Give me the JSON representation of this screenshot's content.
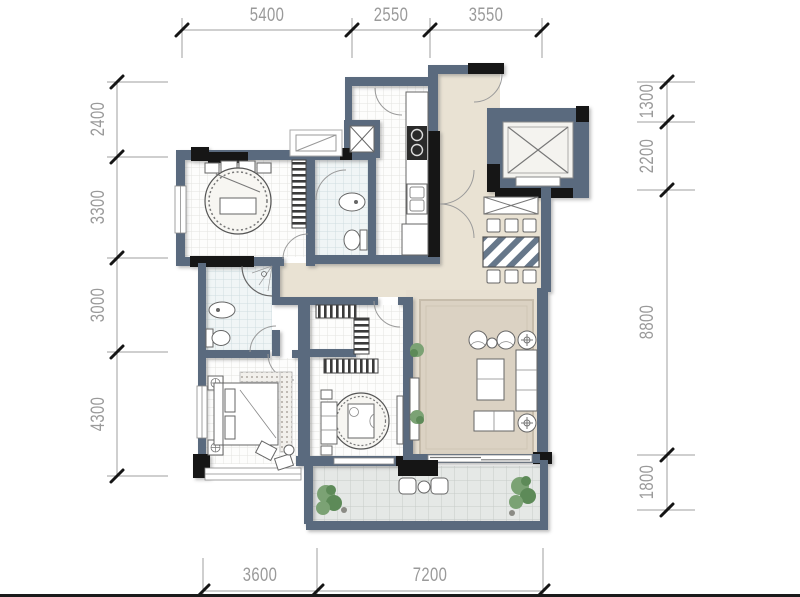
{
  "title": "apartment-floor-plan",
  "dimensions": {
    "top": [
      "5400",
      "2550",
      "3550"
    ],
    "left": [
      "2400",
      "3300",
      "3000",
      "4300"
    ],
    "right": [
      "1300",
      "2200",
      "8800",
      "1800"
    ],
    "bottom": [
      "3600",
      "7200"
    ]
  },
  "colors": {
    "wall": "#5a6a7e",
    "wall_accent": "#151515",
    "floor_hall": "#e9e2d3",
    "rug": "#dbd2c3",
    "tile_bath": "#f0f5f6",
    "tile_balcony": "#e5e8e6",
    "plant": "#7ba274",
    "dimension_text": "#9a9a9a"
  },
  "icons": {
    "elevator": "box-with-x-icon",
    "flue_duct": "box-with-x-icon",
    "door": "quarter-arc-icon"
  }
}
